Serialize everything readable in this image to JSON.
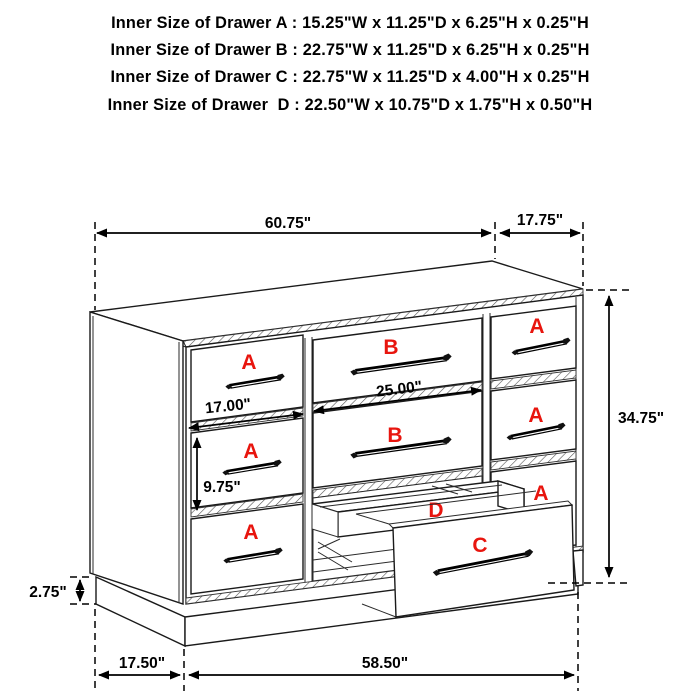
{
  "header": {
    "lines": [
      "Inner Size of Drawer A : 15.25\"W x 11.25\"D x 6.25\"H x 0.25\"H",
      "Inner Size of Drawer B : 22.75\"W x 11.25\"D x 6.25\"H x 0.25\"H",
      "Inner Size of Drawer C : 22.75\"W x 11.25\"D x 4.00\"H x 0.25\"H",
      "Inner Size of Drawer  D : 22.50\"W x 10.75\"D x 1.75\"H x 0.50\"H"
    ]
  },
  "dimensions": {
    "top_width": "60.75\"",
    "top_depth": "17.75\"",
    "height": "34.75\"",
    "drawer_b_width": "25.00\"",
    "drawer_a_width": "17.00\"",
    "drawer_a_height": "9.75\"",
    "base_height": "2.75\"",
    "base_depth": "17.50\"",
    "base_width": "58.50\""
  },
  "drawer_letters": {
    "a": "A",
    "b": "B",
    "c": "C",
    "d": "D"
  },
  "colors": {
    "label_red": "#e8150e",
    "line_black": "#1a1a1a",
    "background": "#ffffff"
  }
}
